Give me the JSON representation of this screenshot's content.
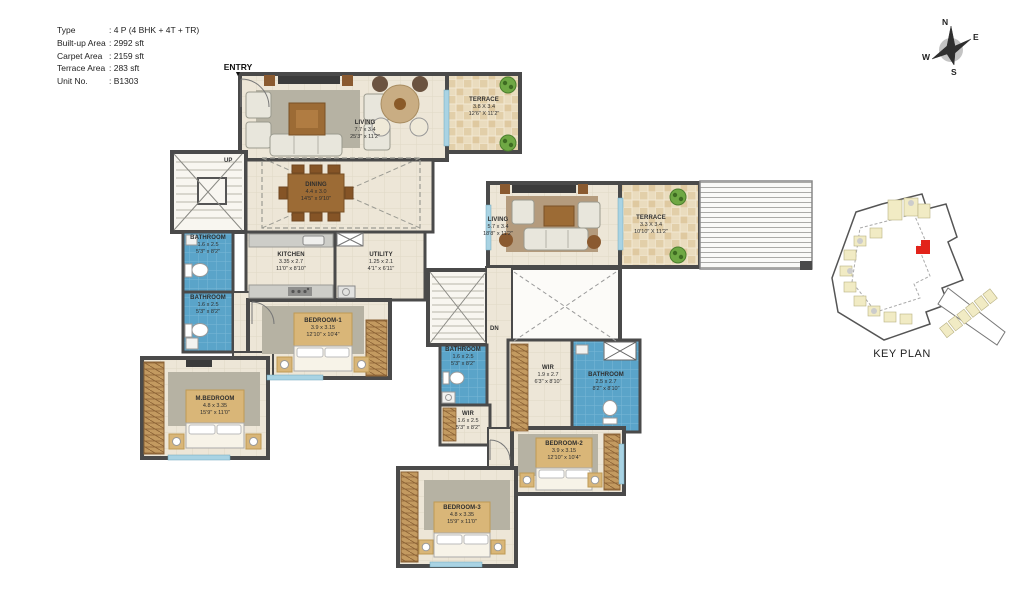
{
  "info": {
    "rows": [
      {
        "label": "Type",
        "value": ": 4 P (4 BHK + 4T + TR)"
      },
      {
        "label": "Built-up Area",
        "value": ": 2992 sft"
      },
      {
        "label": "Carpet Area",
        "value": ": 2159 sft"
      },
      {
        "label": "Terrace Area",
        "value": ": 283 sft"
      },
      {
        "label": "Unit No.",
        "value": ": B1303"
      }
    ]
  },
  "entry": {
    "label": "ENTRY",
    "arrow": "▼"
  },
  "compass": {
    "n": "N",
    "e": "E",
    "s": "S",
    "w": "W"
  },
  "key_plan": {
    "title": "KEY PLAN"
  },
  "stairs": {
    "up": "UP",
    "down": "DN"
  },
  "rooms": {
    "living1": {
      "name": "LIVING",
      "m": "7.7 x 3.4",
      "ft": "25'3\" x 11'2\""
    },
    "terrace1": {
      "name": "TERRACE",
      "m": "3.8 X 3.4",
      "ft": "12'6\" X 11'2\""
    },
    "dining": {
      "name": "DINING",
      "m": "4.4 x 3.0",
      "ft": "14'5\" x 9'10\""
    },
    "kitchen": {
      "name": "KITCHEN",
      "m": "3.35 x 2.7",
      "ft": "11'0\" x 8'10\""
    },
    "utility": {
      "name": "UTILITY",
      "m": "1.25 x 2.1",
      "ft": "4'1\" x 6'11\""
    },
    "bathroom1": {
      "name": "BATHROOM",
      "m": "1.6 x 2.5",
      "ft": "5'3\" x 8'2\""
    },
    "bathroom2": {
      "name": "BATHROOM",
      "m": "1.6 x 2.5",
      "ft": "5'3\" x 8'2\""
    },
    "bedroom1": {
      "name": "BEDROOM-1",
      "m": "3.9 x 3.15",
      "ft": "12'10\" x 10'4\""
    },
    "mbedroom": {
      "name": "M.BEDROOM",
      "m": "4.8 x 3.35",
      "ft": "15'9\" x 11'0\""
    },
    "living2": {
      "name": "LIVING",
      "m": "5.7 x 3.4",
      "ft": "18'8\" x 11'2\""
    },
    "terrace2": {
      "name": "TERRACE",
      "m": "3.3 X 3.4",
      "ft": "10'10\" X 11'2\""
    },
    "bathroom3": {
      "name": "BATHROOM",
      "m": "1.6 x 2.5",
      "ft": "5'3\" x 8'2\""
    },
    "wir1": {
      "name": "WIR",
      "m": "1.9 x 2.7",
      "ft": "6'3\" x 8'10\""
    },
    "bathroom4": {
      "name": "BATHROOM",
      "m": "2.5 x 2.7",
      "ft": "8'2\" x 8'10\""
    },
    "wir2": {
      "name": "WIR",
      "m": "1.6 x 2.5",
      "ft": "5'3\" x 8'2\""
    },
    "bedroom2": {
      "name": "BEDROOM-2",
      "m": "3.9 x 3.15",
      "ft": "12'10\" x 10'4\""
    },
    "bedroom3": {
      "name": "BEDROOM-3",
      "m": "4.8 x 3.35",
      "ft": "15'9\" x 11'0\""
    }
  },
  "colors": {
    "wall": "#4A4A4A",
    "floor": "#EDE6D7",
    "terrace_tile": "#E6D7B8",
    "bathroom_blue": "#5AA4C9",
    "wood": "#9C6B35",
    "bed_panel": "#D9B678",
    "key_plan_building": "#F1EBC4",
    "key_plan_highlight": "#E2231A"
  }
}
